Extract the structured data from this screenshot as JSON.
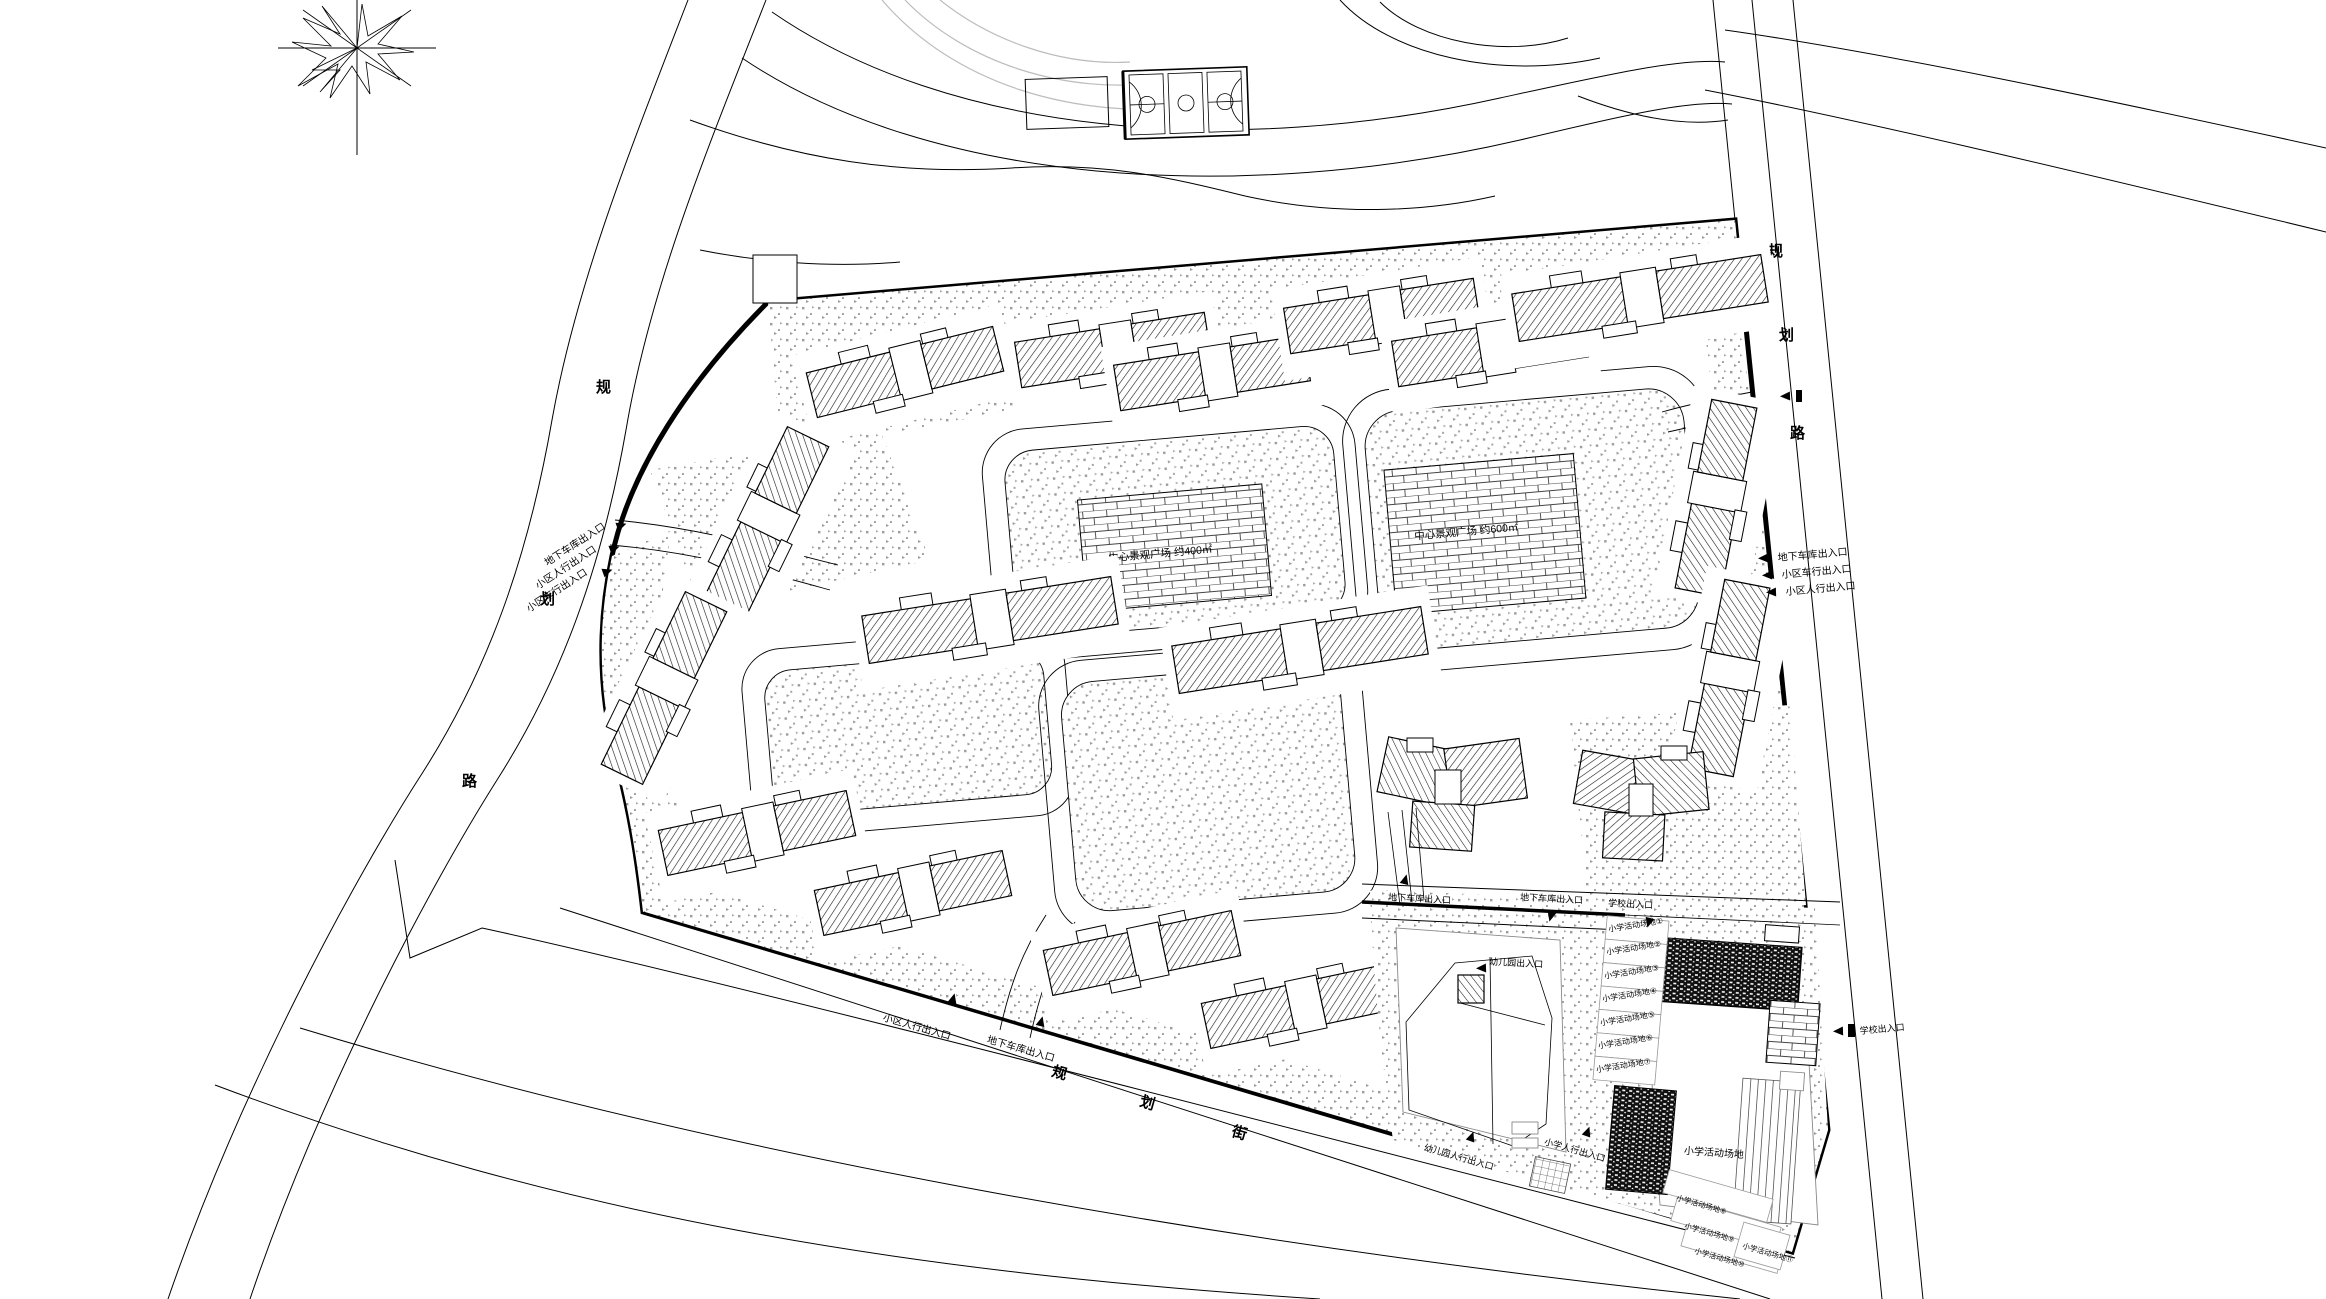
{
  "plan": {
    "background": "#ffffff",
    "colors": {
      "line": "#000000",
      "stipple_dot": "#9b9b9b",
      "contour": "#bdbdbd",
      "boundary": "#000000"
    }
  },
  "roads": {
    "west": {
      "name": "规划路",
      "chars": [
        "规",
        "划",
        "路"
      ]
    },
    "east": {
      "name": "规划路",
      "chars": [
        "规",
        "划",
        "路"
      ]
    },
    "south": {
      "name": "规划街",
      "chars": [
        "规",
        "划",
        "街"
      ]
    }
  },
  "entrances": {
    "west": [
      "地下车库出入口",
      "小区人行出入口",
      "小区车行出入口"
    ],
    "east": [
      "地下车库出入口",
      "小区车行出入口",
      "小区人行出入口"
    ],
    "south": [
      "小区人行出入口",
      "地下车库出入口"
    ],
    "school_top": [
      "地下车库出入口",
      "学校出入口"
    ],
    "school_east": "学校出入口",
    "school_south": [
      "幼儿园人行出入口",
      "小学人行出入口"
    ],
    "kindergarten": "幼儿园出入口"
  },
  "plazas": {
    "west": "中心景观广场 约400㎡",
    "east": "中心景观广场 约600㎡"
  },
  "school": {
    "field_label": "小学活动场地",
    "left_rows": [
      "小学活动场地①",
      "小学活动场地②",
      "小学活动场地③",
      "小学活动场地④",
      "小学活动场地⑤",
      "小学活动场地⑥",
      "小学活动场地⑦"
    ],
    "bottom_rows": [
      "小学活动场地⑧",
      "小学活动场地⑨",
      "小学活动场地⑩",
      "小学活动场地⑪"
    ]
  }
}
